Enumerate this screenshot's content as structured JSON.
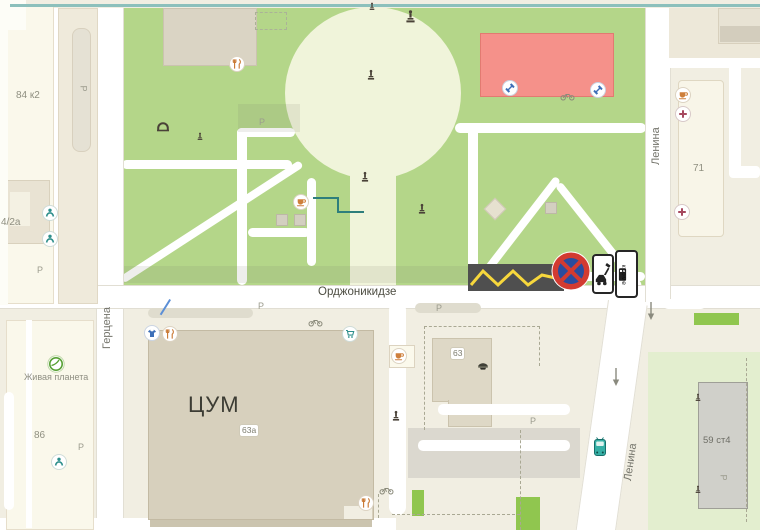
{
  "streets": {
    "ordzhonikidze": "Орджоникидзе",
    "gertsena": "Герцена",
    "lenina_top": "Ленина",
    "lenina_bottom": "Ленина"
  },
  "buildings": {
    "b84k2": "84 к2",
    "b4_2a": "4/2а",
    "b86": "86",
    "tsum": "ЦУМ",
    "b63a": "63а",
    "b63": "63",
    "b71": "71",
    "b59st4": "59 ст4"
  },
  "poi": {
    "zhivaya_planeta": "Живая планета"
  },
  "signs": {
    "krome": "кроме"
  },
  "parking": {
    "label": "Р",
    "positions": [
      {
        "x": 80,
        "y": 84,
        "rot": true
      },
      {
        "x": 37,
        "y": 266
      },
      {
        "x": 258,
        "y": 302
      },
      {
        "x": 436,
        "y": 304
      },
      {
        "x": 530,
        "y": 417
      },
      {
        "x": 78,
        "y": 443
      },
      {
        "x": 720,
        "y": 473,
        "rot": true
      },
      {
        "x": 259,
        "y": 118
      }
    ]
  },
  "markers": [
    {
      "name": "cafe-icon",
      "kind": "cafe",
      "x": 683,
      "y": 95
    },
    {
      "name": "medical-icon",
      "kind": "medical",
      "x": 683,
      "y": 114
    },
    {
      "name": "medical-icon",
      "kind": "medical",
      "x": 682,
      "y": 212
    },
    {
      "name": "restaurant-icon",
      "kind": "restaurant",
      "x": 237,
      "y": 64
    },
    {
      "name": "cafe-icon",
      "kind": "cafe",
      "x": 301,
      "y": 202
    },
    {
      "name": "fitness-icon",
      "kind": "fitness",
      "x": 510,
      "y": 88
    },
    {
      "name": "fitness-icon",
      "kind": "fitness",
      "x": 598,
      "y": 90
    },
    {
      "name": "person-icon",
      "kind": "person",
      "x": 50,
      "y": 213
    },
    {
      "name": "person-icon",
      "kind": "person",
      "x": 50,
      "y": 239
    },
    {
      "name": "store-icon",
      "kind": "store",
      "x": 152,
      "y": 333
    },
    {
      "name": "restaurant-icon",
      "kind": "restaurant",
      "x": 170,
      "y": 334
    },
    {
      "name": "cart-icon",
      "kind": "cart",
      "x": 350,
      "y": 334
    },
    {
      "name": "cafe-icon",
      "kind": "cafe",
      "x": 399,
      "y": 356
    },
    {
      "name": "person-icon",
      "kind": "person",
      "x": 59,
      "y": 462
    },
    {
      "name": "planet-icon",
      "kind": "planet",
      "x": 56,
      "y": 364
    },
    {
      "name": "restaurant-icon",
      "kind": "restaurant",
      "x": 366,
      "y": 503
    }
  ],
  "glyphs": [
    {
      "name": "statue-icon",
      "kind": "statue",
      "x": 410,
      "y": 17,
      "interactable": false
    },
    {
      "name": "monument-icon",
      "kind": "monument",
      "x": 372,
      "y": 6,
      "small": true,
      "interactable": false
    },
    {
      "name": "monument-icon",
      "kind": "monument",
      "x": 371,
      "y": 75,
      "interactable": false
    },
    {
      "name": "monument-icon",
      "kind": "monument",
      "x": 365,
      "y": 177,
      "interactable": false
    },
    {
      "name": "monument-icon",
      "kind": "monument",
      "x": 422,
      "y": 209,
      "interactable": false
    },
    {
      "name": "monument-icon",
      "kind": "monument",
      "x": 396,
      "y": 416,
      "interactable": false
    },
    {
      "name": "monument-icon",
      "kind": "monument",
      "x": 200,
      "y": 136,
      "small": true,
      "interactable": false
    },
    {
      "name": "monument-icon",
      "kind": "monument",
      "x": 698,
      "y": 397,
      "small": true,
      "interactable": false
    },
    {
      "name": "monument-icon",
      "kind": "monument",
      "x": 698,
      "y": 489,
      "small": true,
      "interactable": false
    },
    {
      "name": "bench-icon",
      "kind": "bench",
      "x": 163,
      "y": 127,
      "interactable": false
    },
    {
      "name": "police-icon",
      "kind": "police",
      "x": 483,
      "y": 366,
      "interactable": true
    },
    {
      "name": "bus-icon",
      "kind": "bus",
      "x": 600,
      "y": 447,
      "interactable": true
    },
    {
      "name": "one-way-arrow-icon",
      "kind": "arrow",
      "x": 651,
      "y": 311,
      "interactable": false
    },
    {
      "name": "one-way-arrow-icon",
      "kind": "arrow",
      "x": 616,
      "y": 377,
      "interactable": false
    },
    {
      "name": "bicycle-parking-icon",
      "kind": "bicycle",
      "x": 315,
      "y": 322,
      "interactable": false
    },
    {
      "name": "bicycle-parking-icon",
      "kind": "bicycle",
      "x": 386,
      "y": 490,
      "interactable": false
    },
    {
      "name": "bicycle-parking-icon",
      "kind": "bicycle",
      "x": 567,
      "y": 96,
      "interactable": false
    }
  ],
  "colors": {
    "park": "#B4D689",
    "plaza": "#F0F4DA",
    "road": "#FFFFFF",
    "block": "#F1EEE2",
    "building_cream": "#FAF8EB",
    "tsum": "#D7D0BD",
    "red_building": "#F5918A",
    "dark_road": "#4F4F4F",
    "marking_yellow": "#F7D73C",
    "light_green": "#E3EECF",
    "bright_green": "#90C64F",
    "sign_red": "#D23B31",
    "sign_blue": "#2A4C9E",
    "teal_accent": "#2E8F8C"
  }
}
